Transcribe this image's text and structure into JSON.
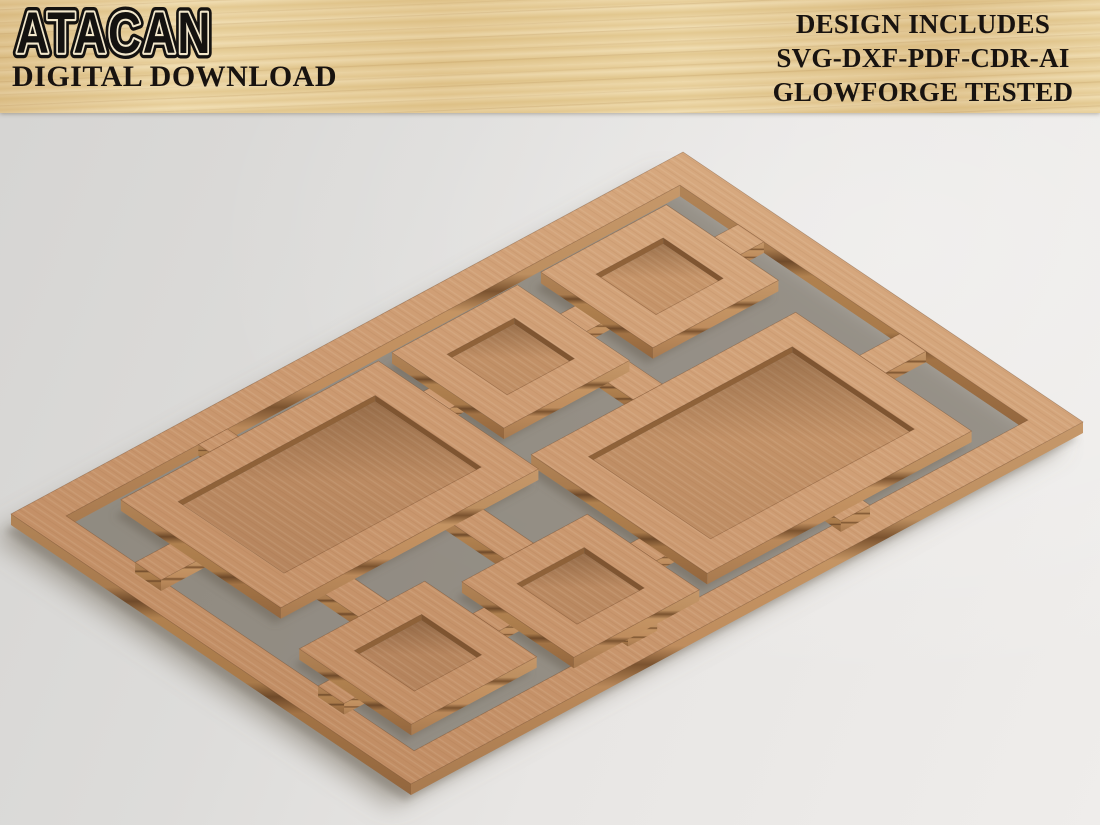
{
  "header": {
    "brand": {
      "logo_text": "ATACAN",
      "subtitle": "DIGITAL DOWNLOAD"
    },
    "info_lines": [
      "DESIGN INCLUDES",
      "SVG-DXF-PDF-CDR-AI",
      "GLOWFORGE TESTED"
    ]
  },
  "scene": {
    "description": "Isometric 3D render of a laser-cut plywood sheet: an outer rectangular sheet frame holding six picture-frame trays of assorted sizes (two large rectangles and four small squares), each still attached by small sprue tabs, lying on a neutral grey studio background.",
    "frame_count": 6,
    "colors": {
      "wood_top": "#cd9b72",
      "wood_side_right": "#bd8f60",
      "wood_side_left": "#a87a4e",
      "wood_glue_line": "#7b532f",
      "wood_floor": "#bf8c62",
      "header_wood": "#e9d4a5",
      "text": "#181310",
      "background_light": "#efedeb",
      "background_dark": "#d5d4d2"
    }
  }
}
